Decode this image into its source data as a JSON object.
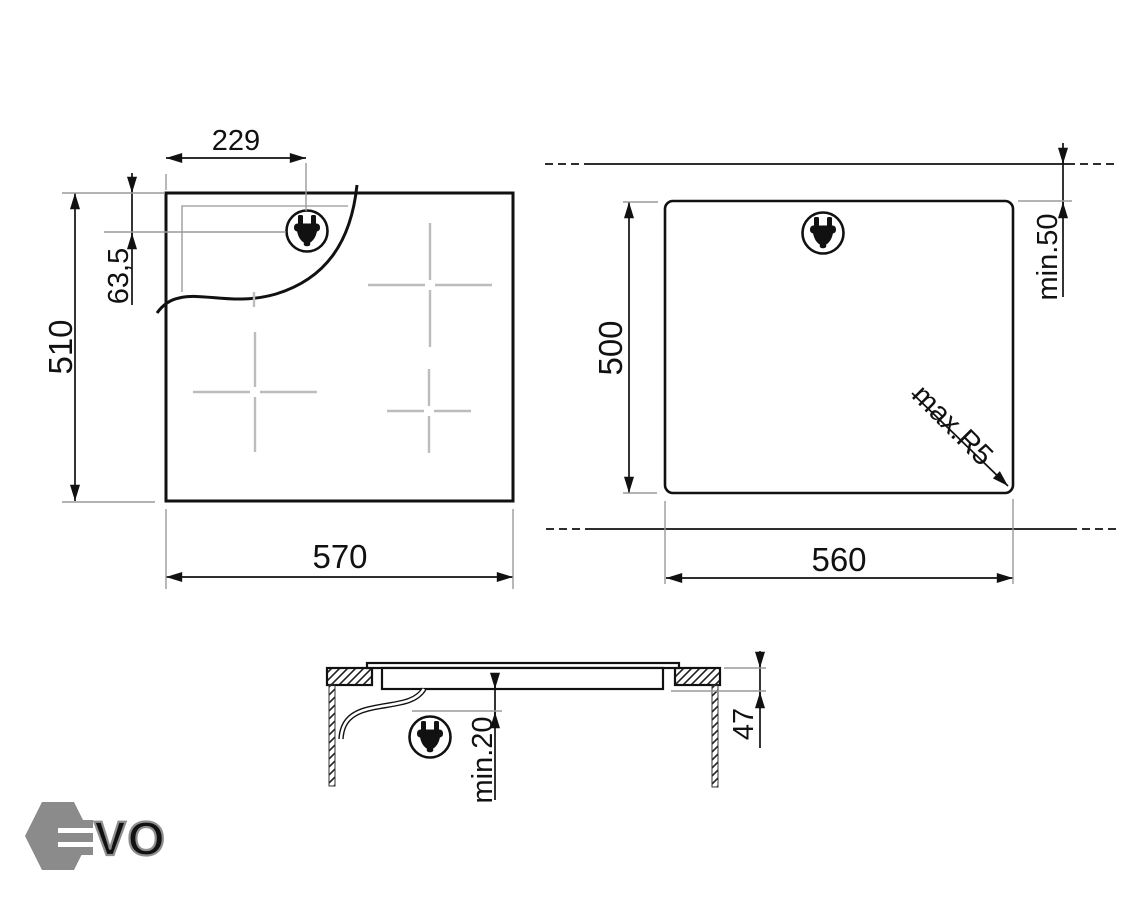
{
  "drawing": {
    "top_view": {
      "width_mm": "570",
      "height_mm": "510",
      "plug_offset_x_mm": "229",
      "plug_offset_y_mm": "63,5"
    },
    "cutout_view": {
      "width_mm": "560",
      "depth_mm": "500",
      "rear_clearance": "min.50",
      "corner_radius": "max.R5"
    },
    "section_view": {
      "recess_depth_mm": "47",
      "bottom_clearance": "min.20"
    }
  },
  "icons": {
    "plug": "power-plug-icon"
  },
  "logo": {
    "brand": "EVO",
    "outline_letters": "VO"
  },
  "colors": {
    "line": "#111111",
    "extension_line": "#9a9a9a",
    "zone_marker": "#bcbcbc",
    "logo_gray": "#8b8b8b",
    "background": "#ffffff"
  }
}
